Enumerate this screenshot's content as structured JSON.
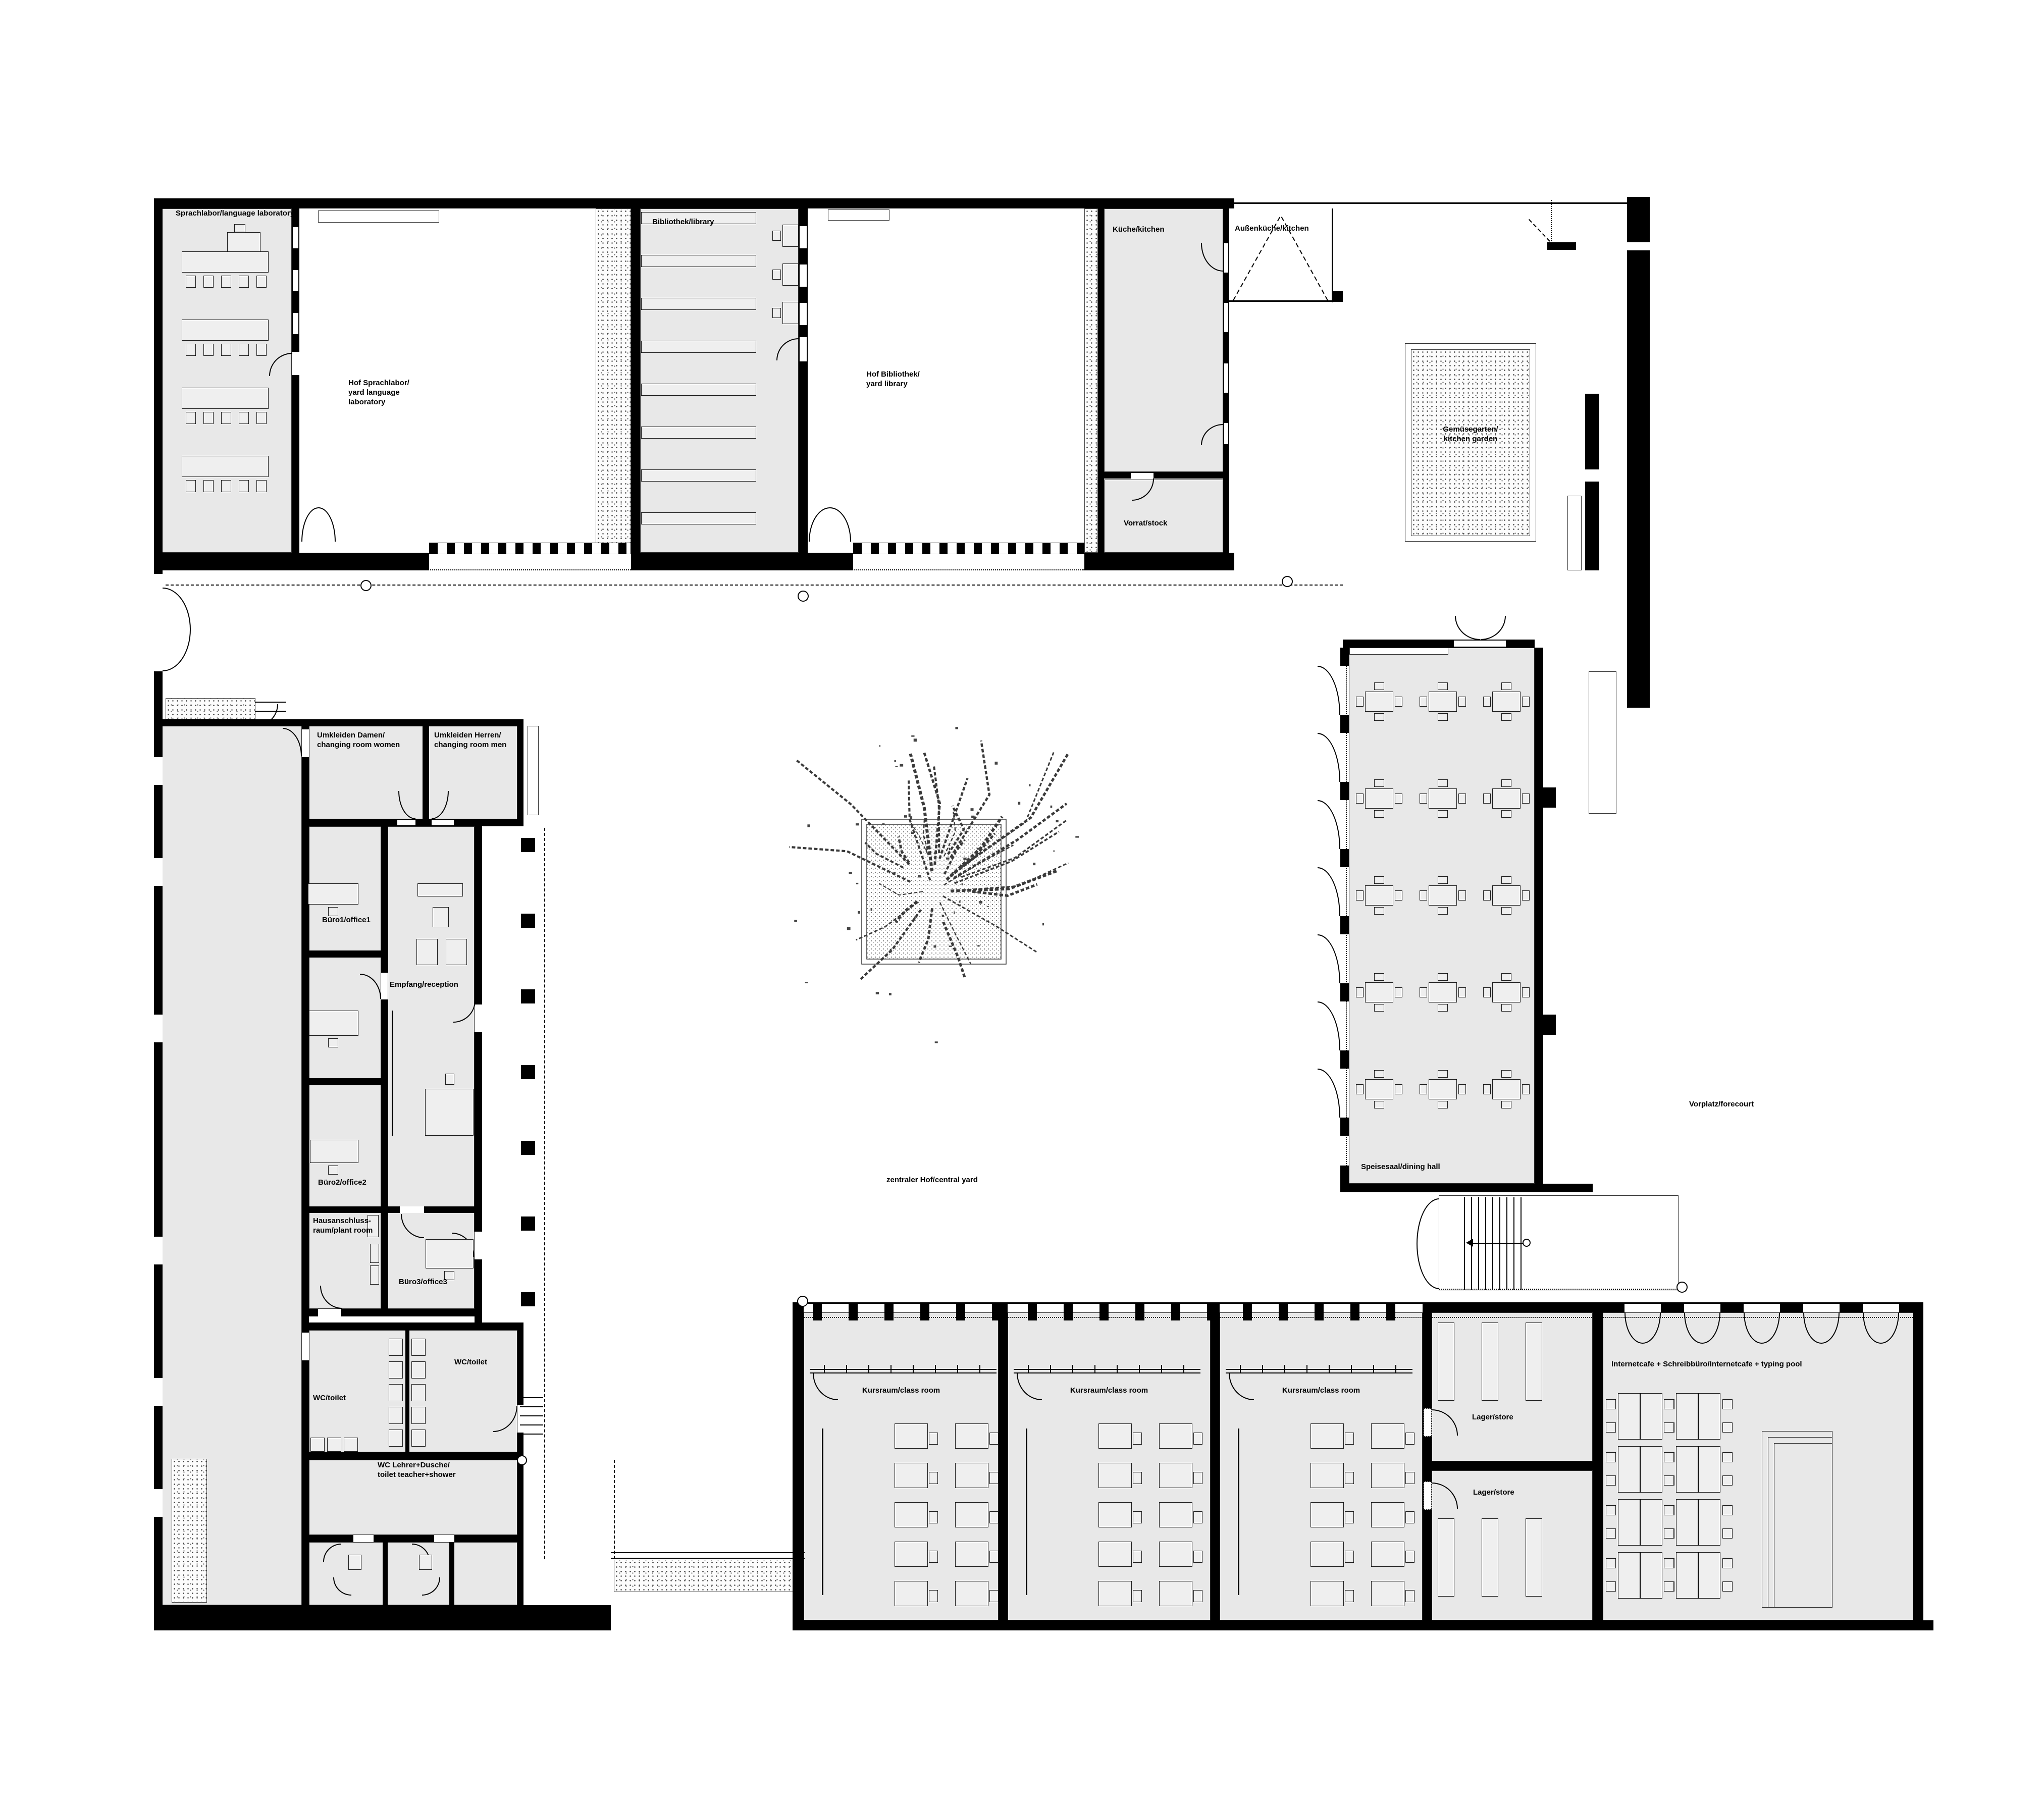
{
  "rooms": {
    "sprachlabor": "Sprachlabor/language laboratory",
    "hof_sprachlabor": "Hof Sprachlabor/\nyard language\nlaboratory",
    "bibliothek": "Bibliothek/library",
    "hof_bibliothek": "Hof Bibliothek/\ny​ard library",
    "kueche": "Küche/kitchen",
    "aussenkueche": "Außenküche/kitchen",
    "vorrat": "Vorrat/stock",
    "gemuesegarten": "Gemüsegarten/\nkitchen garden",
    "umkleiden_damen": "Umkleiden Damen/\nchanging room women",
    "umkleiden_herren": "Umkleiden Herren/\nchanging room men",
    "buero1": "Büro1/office1",
    "empfang": "Empfang/reception",
    "buero2": "Büro2/office2",
    "hausanschluss": "Hausanschluss-\nraum/plant room",
    "buero3": "Büro3/office3",
    "wc_links": "WC/toilet",
    "wc_rechts": "WC/toilet",
    "wc_lehrer": "WC Lehrer+Dusche/\ntoilet teacher+shower",
    "zentraler_hof": "zentraler Hof/central yard",
    "speisesaal": "Speisesaal/dining hall",
    "vorplatz": "Vorplatz/forecourt",
    "kursraum1": "Kursraum/class room",
    "kursraum2": "Kursraum/class room",
    "kursraum3": "Kursraum/class room",
    "lager1": "Lager/store",
    "lager2": "Lager/store",
    "internetcafe": "Internetcafe + Schreibbüro/Internetcafe + typing pool"
  },
  "colors": {
    "wall": "#000000",
    "floor": "#e8e8e8",
    "paper": "#ffffff",
    "linework": "#2e2e2e"
  }
}
